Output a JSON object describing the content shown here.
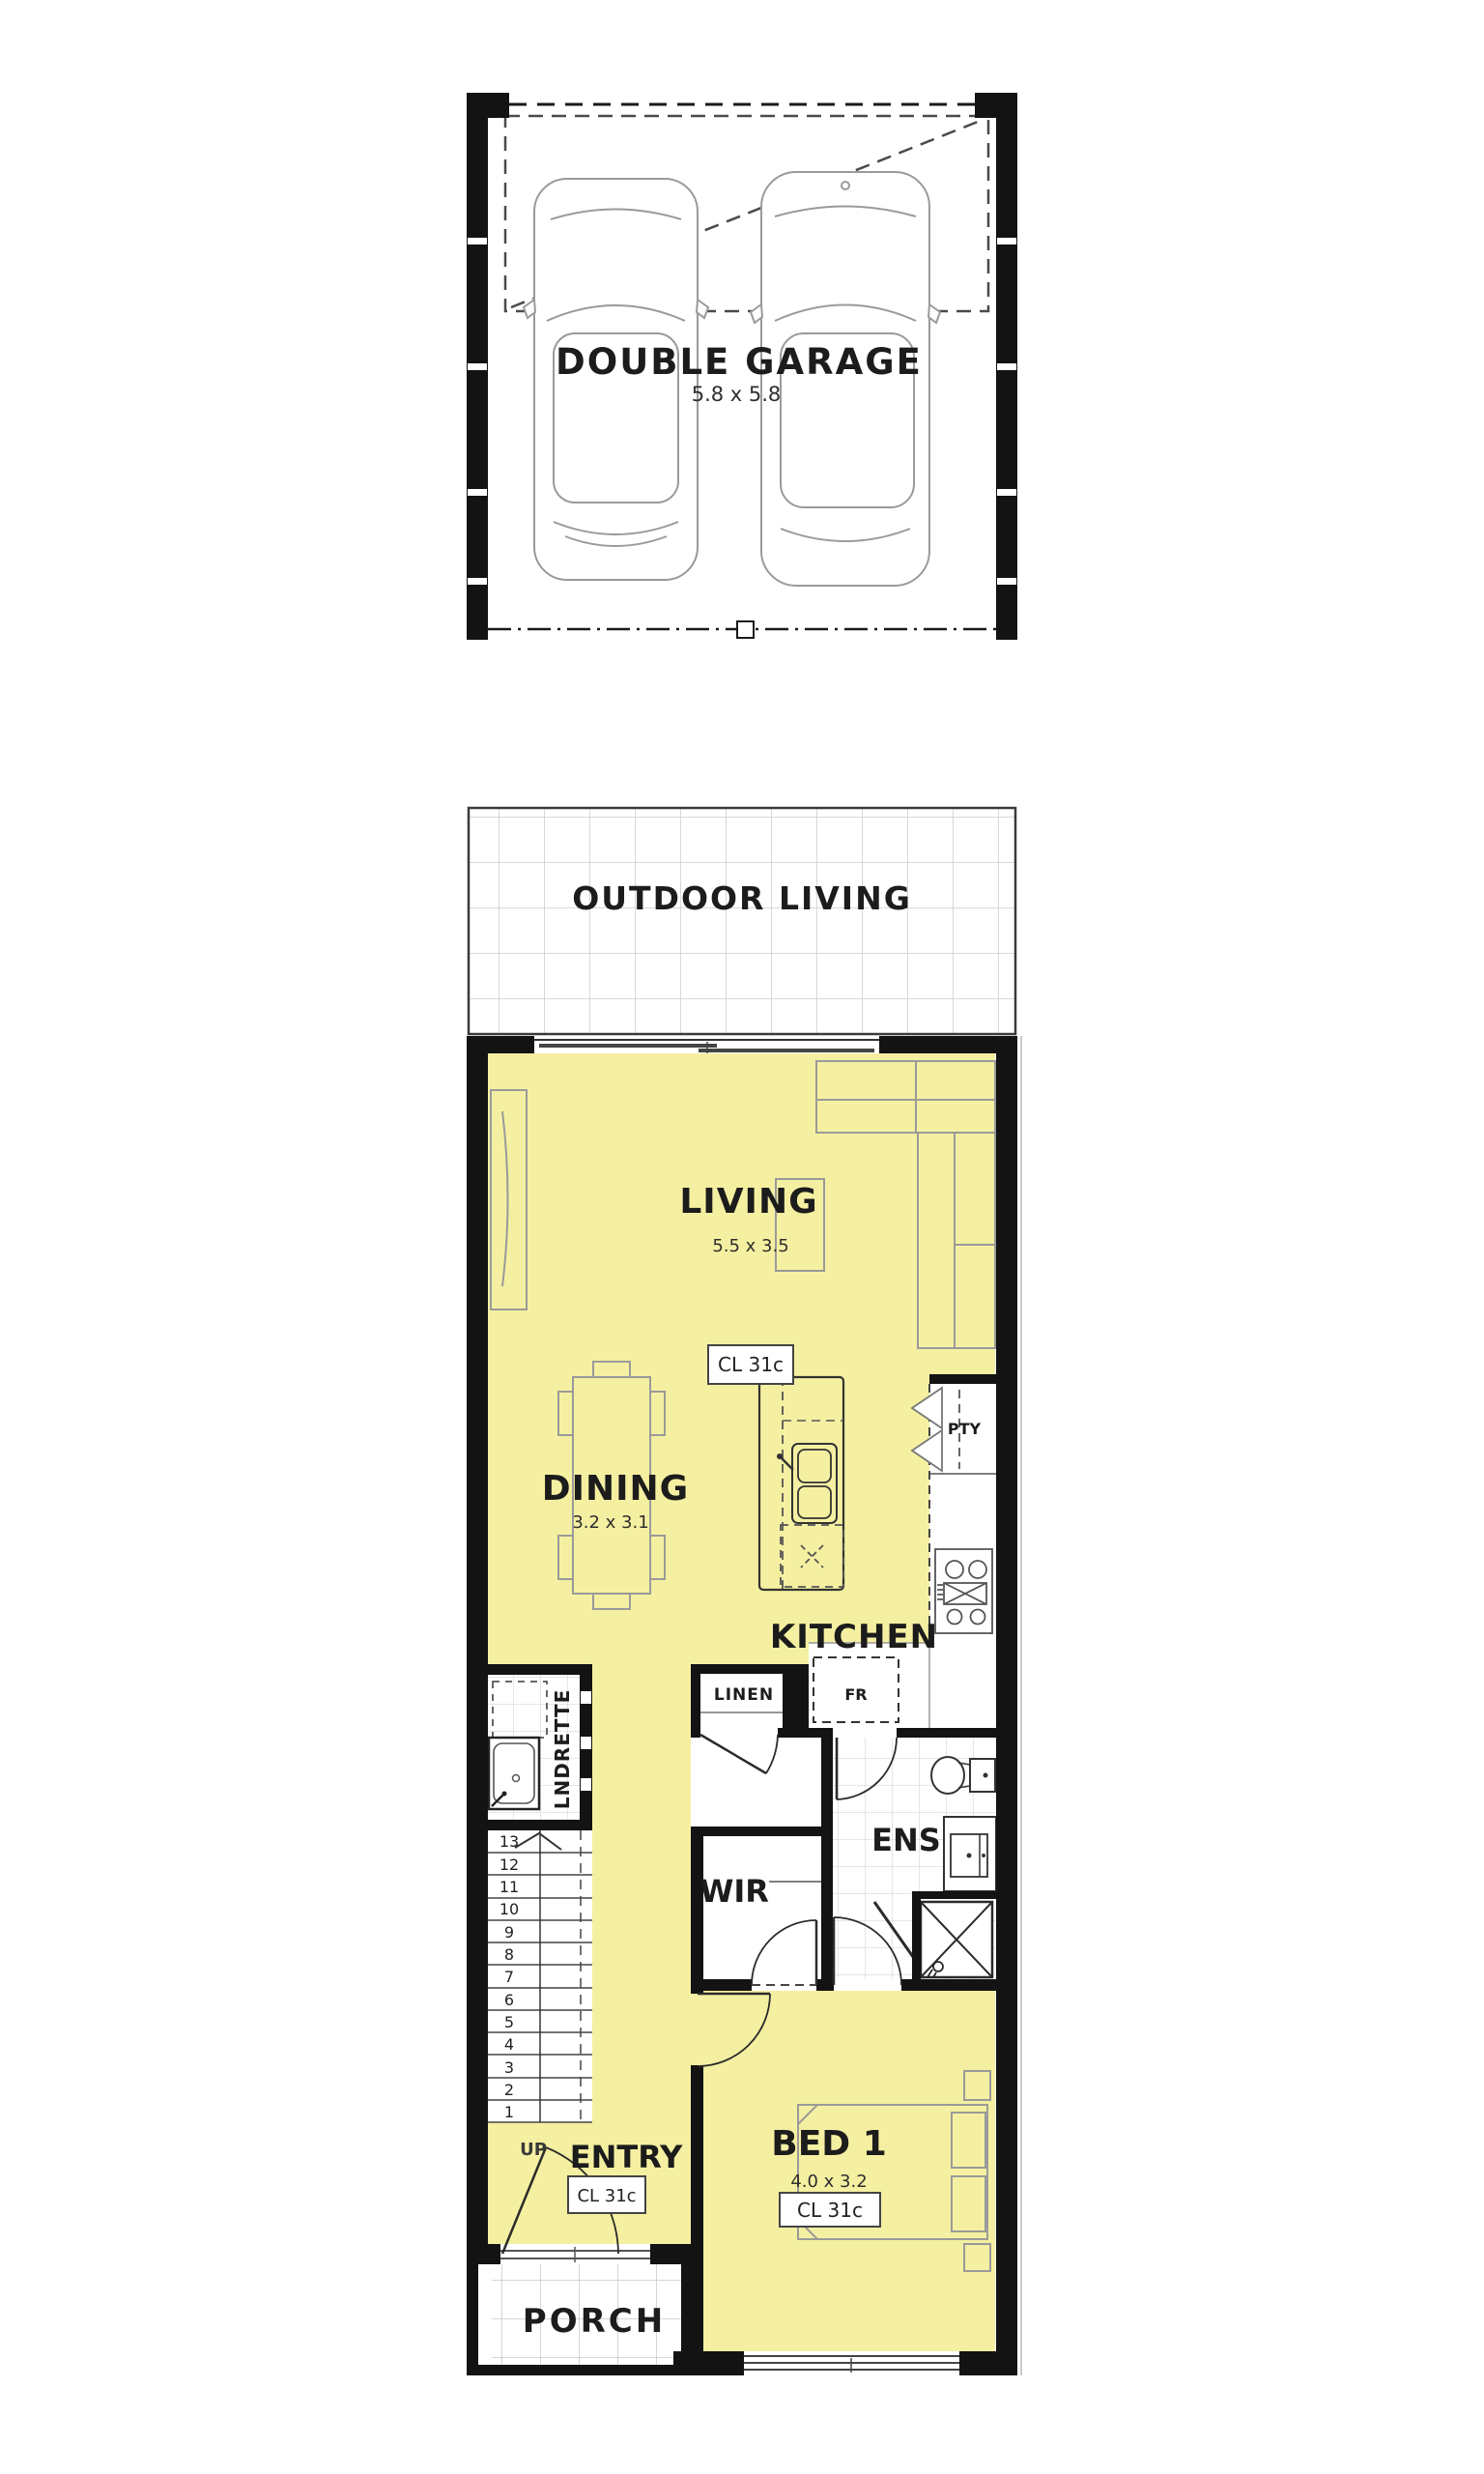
{
  "plan": {
    "garage": {
      "label": "DOUBLE GARAGE",
      "size": "5.8 x 5.8"
    },
    "outdoor_living": {
      "label": "OUTDOOR LIVING"
    },
    "living": {
      "label": "LIVING",
      "size": "5.5 x 3.5",
      "ceiling": "CL 31c"
    },
    "dining": {
      "label": "DINING",
      "size": "3.2 x 3.1"
    },
    "kitchen": {
      "label": "KITCHEN",
      "pantry_label": "PTY",
      "linen_label": "LINEN",
      "fridge_label": "FR"
    },
    "laundry": {
      "label": "LNDRETTE"
    },
    "stairs": {
      "up_label": "UP",
      "steps": [
        "13",
        "12",
        "11",
        "10",
        "9",
        "8",
        "7",
        "6",
        "5",
        "4",
        "3",
        "2",
        "1"
      ]
    },
    "wir": {
      "label": "WIR"
    },
    "ensuite": {
      "label": "ENS"
    },
    "entry": {
      "label": "ENTRY",
      "ceiling": "CL 31c"
    },
    "bed1": {
      "label": "BED 1",
      "size": "4.0 x 3.2",
      "ceiling": "CL 31c"
    },
    "porch": {
      "label": "PORCH"
    },
    "colors": {
      "floor_highlight": "#f5f0a1",
      "wall": "#131313",
      "furniture_line": "#9a9a9a",
      "tile_line": "#cccccc",
      "fixture_line": "#333333"
    }
  }
}
